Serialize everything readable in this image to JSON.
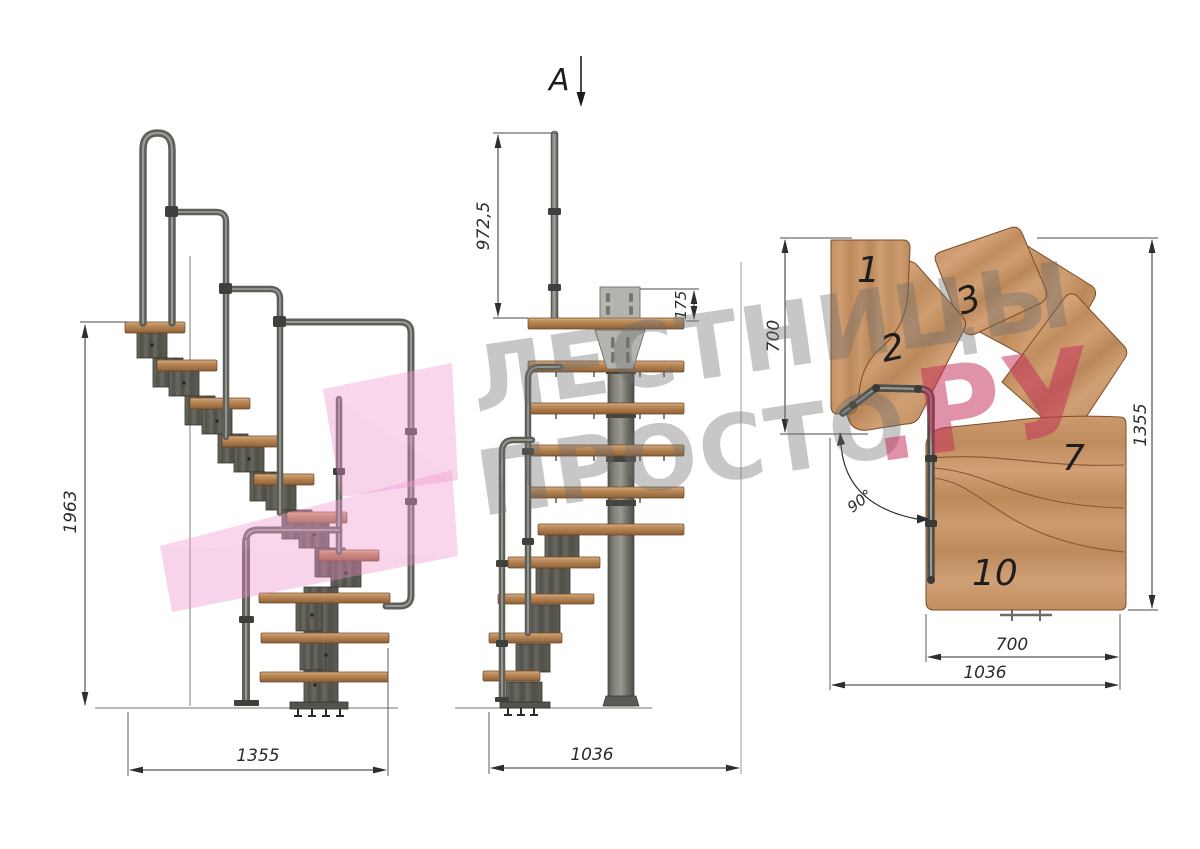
{
  "title": "Modular staircase technical drawing",
  "watermark": {
    "line1": "ЛЕСТНИЦЫ",
    "line2": "ПРОСТО",
    "accent": ".РУ",
    "gray_color": "#6d6d6d",
    "accent_color": "#c42f5a",
    "logo_color": "#f29ed3"
  },
  "section": {
    "label": "A"
  },
  "side_view": {
    "height": "1963",
    "width": "1355"
  },
  "front_view": {
    "post_height": "972,5",
    "bracket_height": "175",
    "width": "1036"
  },
  "plan_view": {
    "depth": "700",
    "height": "1355",
    "tread_width": "700",
    "width": "1036",
    "angle": "90°",
    "tread_numbers": {
      "n1": "1",
      "n2": "2",
      "n3": "3",
      "n7": "7",
      "n10": "10"
    }
  },
  "colors": {
    "wood": "#c79468",
    "metal": "#5a5a54",
    "dimension_lines": "#2e2e2e",
    "background": "#ffffff"
  }
}
